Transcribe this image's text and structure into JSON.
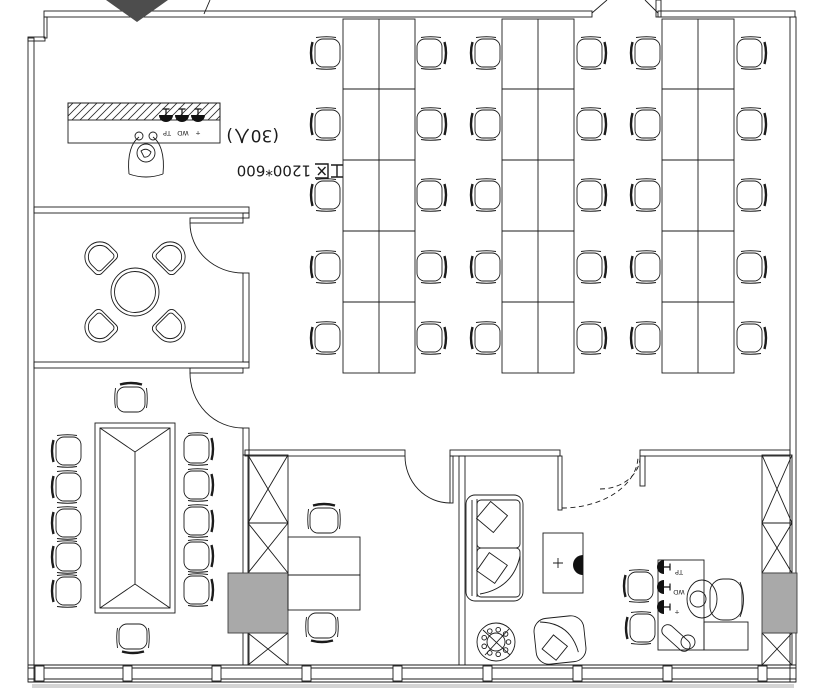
{
  "drawing": {
    "labels": {
      "workzone_full": "工区 1200*600",
      "workzone_prefix": "工区",
      "workzone_size": "1200*600",
      "capacity_full": "(30人)",
      "capacity_open": "(30",
      "capacity_suffix": "人",
      "capacity_close": ")"
    },
    "outlets": {
      "reception": [
        "TP",
        "WD",
        "+"
      ],
      "exec_desk": [
        "TP",
        "WD",
        "+"
      ]
    },
    "colors": {
      "line": "#1b1b1b",
      "column_fill": "#a9a9a9",
      "entry_marker": "#4d4d4d",
      "shadow": "#c9c9c9",
      "symbol_fill": "#111111",
      "background": "#ffffff"
    }
  }
}
